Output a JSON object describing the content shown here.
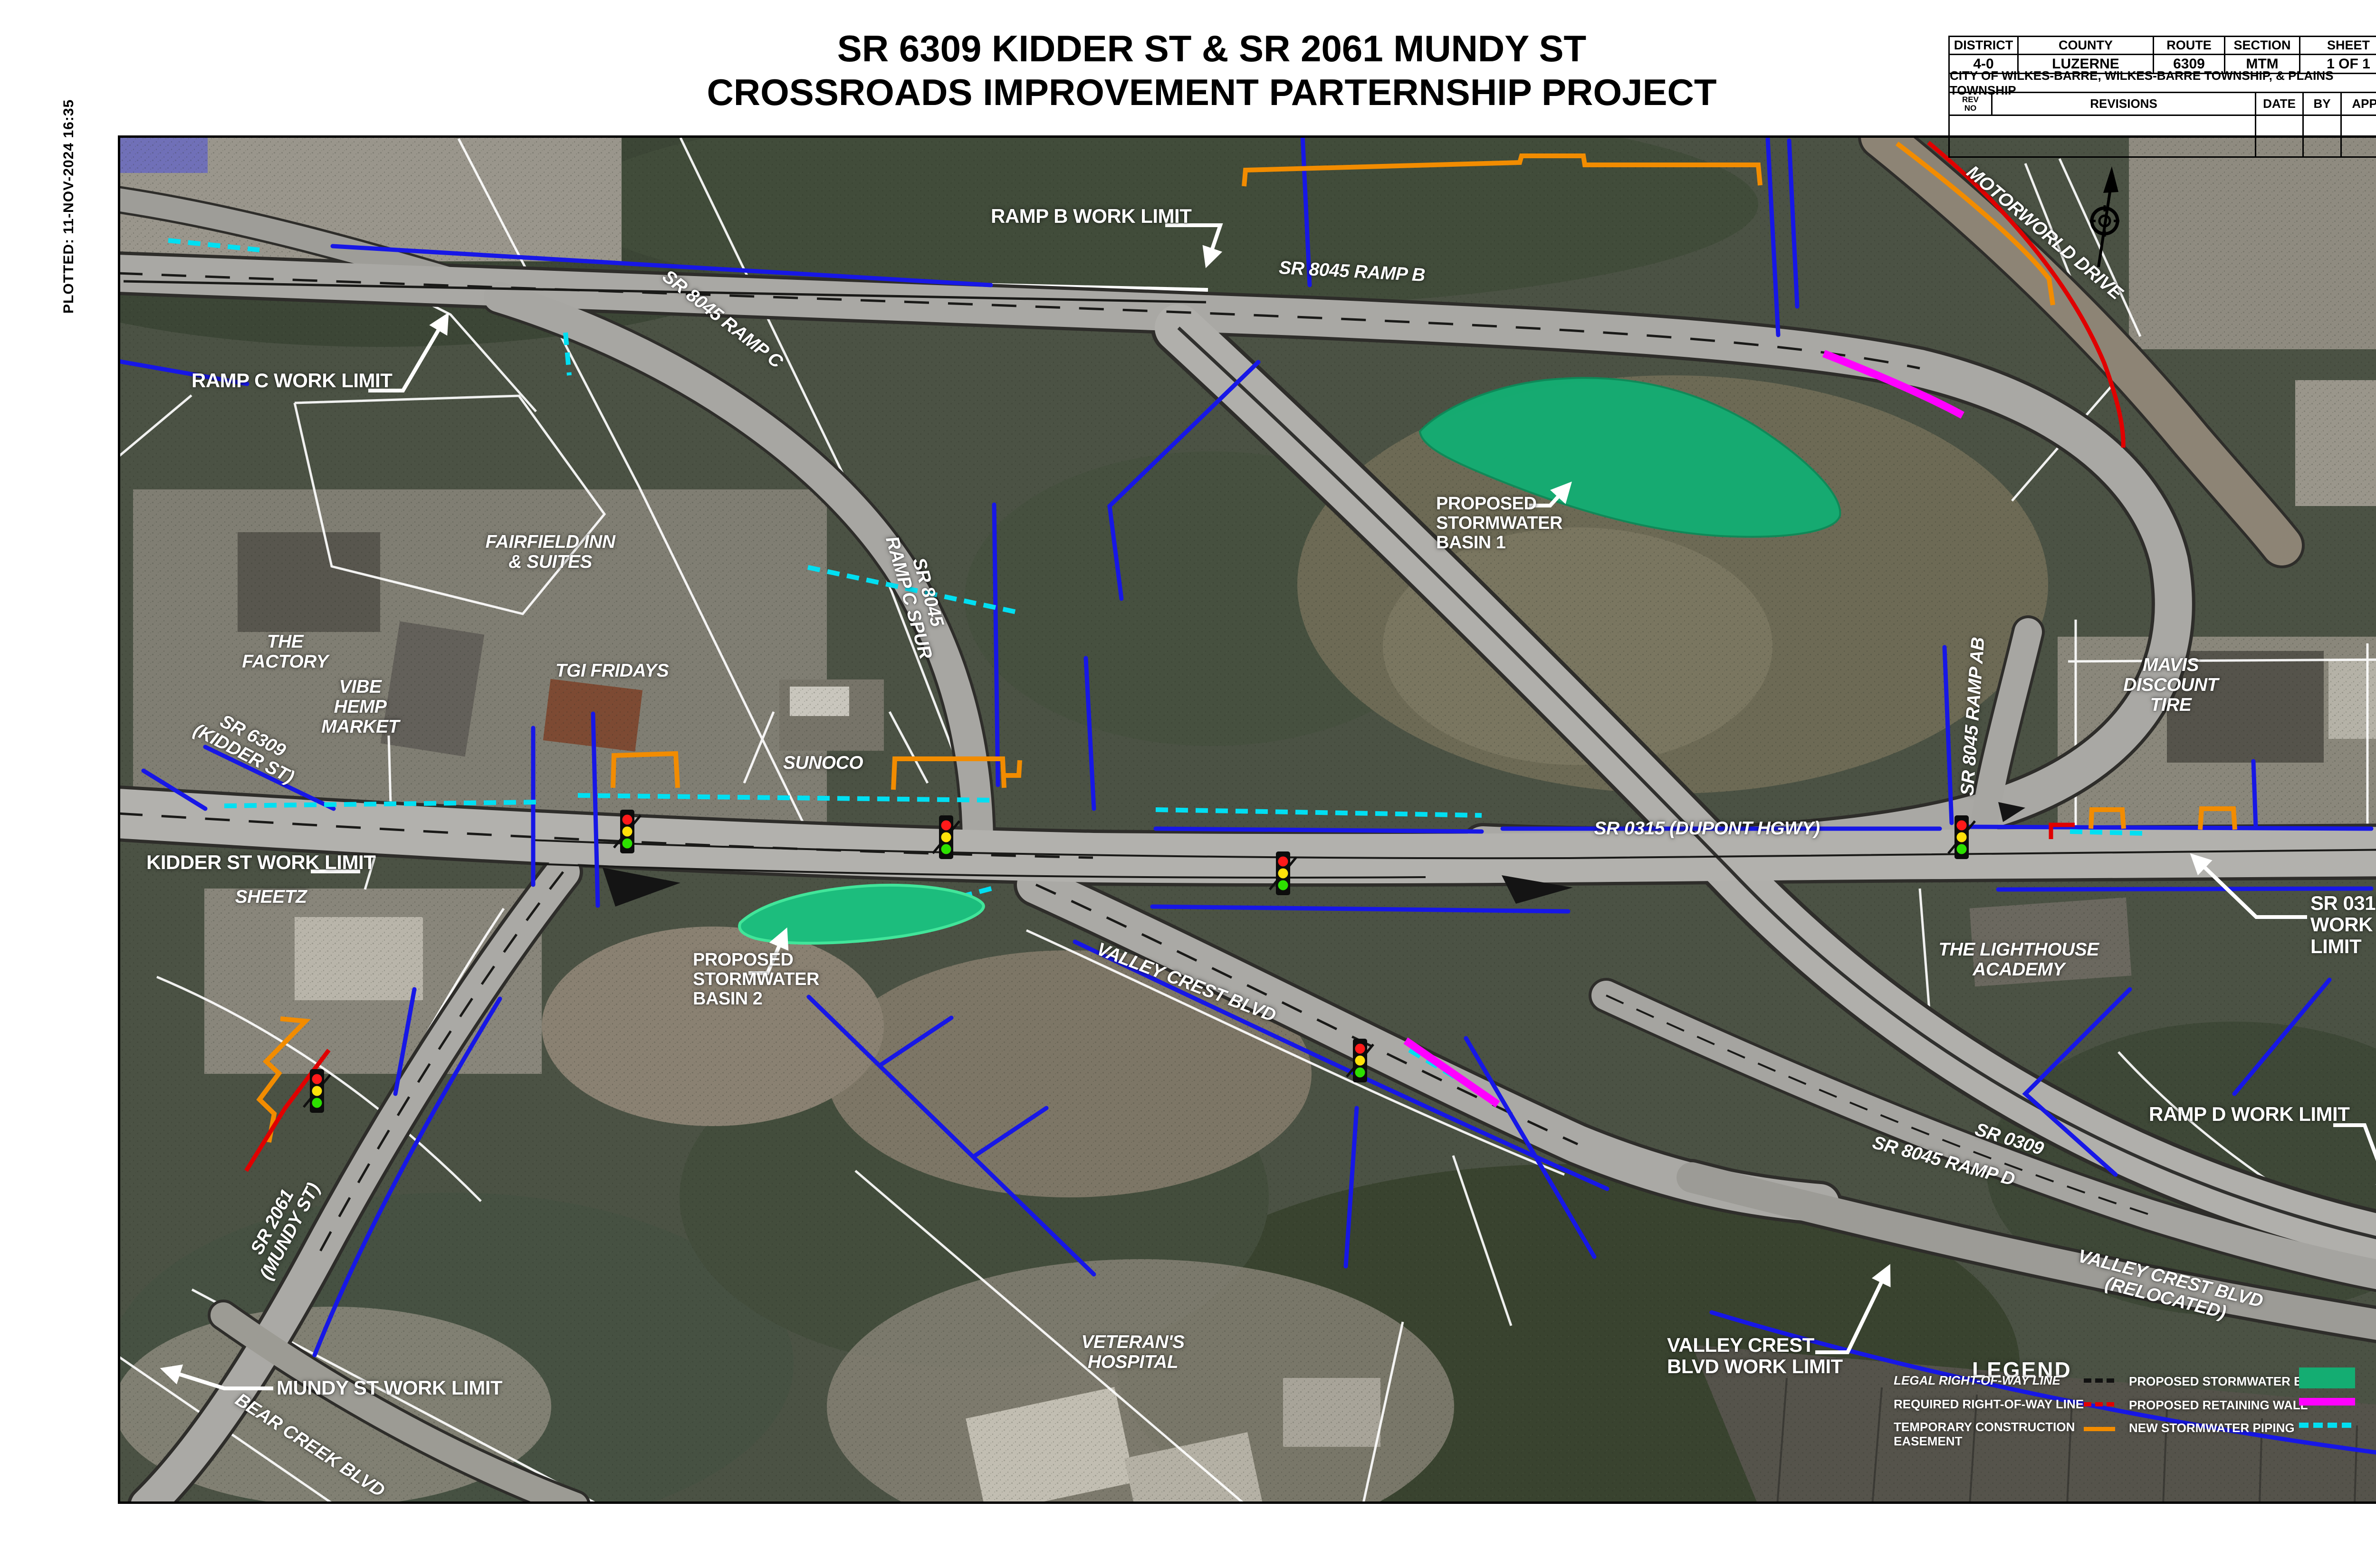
{
  "sheet": {
    "plotted": "PLOTTED:  11-NOV-2024 16:35",
    "title_line1": "SR 6309 KIDDER ST & SR 2061 MUNDY ST",
    "title_line2": "CROSSROADS IMPROVEMENT PARTERNSHIP PROJECT"
  },
  "title_block": {
    "headers": {
      "district": "DISTRICT",
      "county": "COUNTY",
      "route": "ROUTE",
      "section": "SECTION",
      "sheet": "SHEET"
    },
    "values": {
      "district": "4-0",
      "county": "LUZERNE",
      "route": "6309",
      "section": "MTM",
      "sheet": "1 OF 1"
    },
    "city_row": "CITY OF WILKES-BARRE, WILKES-BARRE TOWNSHIP, & PLAINS TOWNSHIP",
    "rev": {
      "rev_no": "REV\nNO",
      "revisions": "REVISIONS",
      "date": "DATE",
      "by": "BY",
      "appd": "APPD"
    }
  },
  "map": {
    "labels": {
      "ramp_b_work_limit": "RAMP B WORK LIMIT",
      "sr8045_ramp_b": "SR 8045 RAMP B",
      "ramp_c_work_limit": "RAMP C WORK LIMIT",
      "sr8045_ramp_c": "SR 8045 RAMP C",
      "motorworld_drive": "MOTORWORLD DRIVE",
      "basin1": "PROPOSED\nSTORMWATER\nBASIN 1",
      "sr8045_ramp_c_spur": "SR 8045\nRAMP C SPUR",
      "fairfield": "FAIRFIELD INN\n& SUITES",
      "the_factory": "THE\nFACTORY",
      "vibe": "VIBE\nHEMP\nMARKET",
      "tgi_fridays": "TGI FRIDAYS",
      "sunoco": "SUNOCO",
      "sr6309_kidder": "SR 6309\n(KIDDER ST)",
      "kidder_work_limit": "KIDDER ST WORK LIMIT",
      "sheetz": "SHEETZ",
      "basin2": "PROPOSED\nSTORMWATER\nBASIN 2",
      "valley_crest_blvd": "VALLEY CREST BLVD",
      "sr0315_dupont": "SR 0315  (DUPONT  HGWY)",
      "mavis": "MAVIS\nDISCOUNT\nTIRE",
      "sr8045_ramp_ab": "SR 8045 RAMP AB",
      "sr0315_work_limit": "SR 0315\nWORK LIMIT",
      "lighthouse": "THE LIGHTHOUSE\nACADEMY",
      "ramp_d_work_limit": "RAMP D WORK LIMIT",
      "sr0309": "SR 0309",
      "sr8045_ramp_d": "SR 8045 RAMP D",
      "vc_relocated": "VALLEY CREST BLVD\n(RELOCATED)",
      "vc_work_limit": "VALLEY CREST\nBLVD WORK LIMIT",
      "veterans": "VETERAN'S\nHOSPITAL",
      "mundy_work_limit": "MUNDY ST WORK LIMIT",
      "sr2061_mundy": "SR 2061\n(MUNDY ST)",
      "bear_creek": "BEAR CREEK BLVD"
    },
    "icons": {
      "north_arrow": "north-arrow-compass-icon",
      "traffic_signal": "traffic-signal-icon"
    }
  },
  "legend": {
    "title": "LEGEND",
    "left": [
      {
        "label": "LEGAL RIGHT-OF-WAY LINE",
        "swatch": "black-dashed-line"
      },
      {
        "label": "REQUIRED RIGHT-OF-WAY LINE",
        "swatch": "red-dashed-line"
      },
      {
        "label": "TEMPORARY CONSTRUCTION\nEASEMENT",
        "swatch": "orange-line"
      }
    ],
    "right": [
      {
        "label": "PROPOSED STORMWATER BASIN",
        "swatch": "green-fill"
      },
      {
        "label": "PROPOSED RETAINING WALL",
        "swatch": "magenta-bar"
      },
      {
        "label": "NEW STORMWATER PIPING",
        "swatch": "cyan-dashed-line"
      }
    ]
  },
  "colors": {
    "basin_green": "#14ad72",
    "retaining_wall_magenta": "#ff00ff",
    "stormwater_piping_cyan": "#00dff2",
    "temporary_construction_orange": "#f28c00",
    "required_row_red": "#e00000",
    "legal_row_black": "#111111",
    "utility_blue": "#1717e6"
  }
}
